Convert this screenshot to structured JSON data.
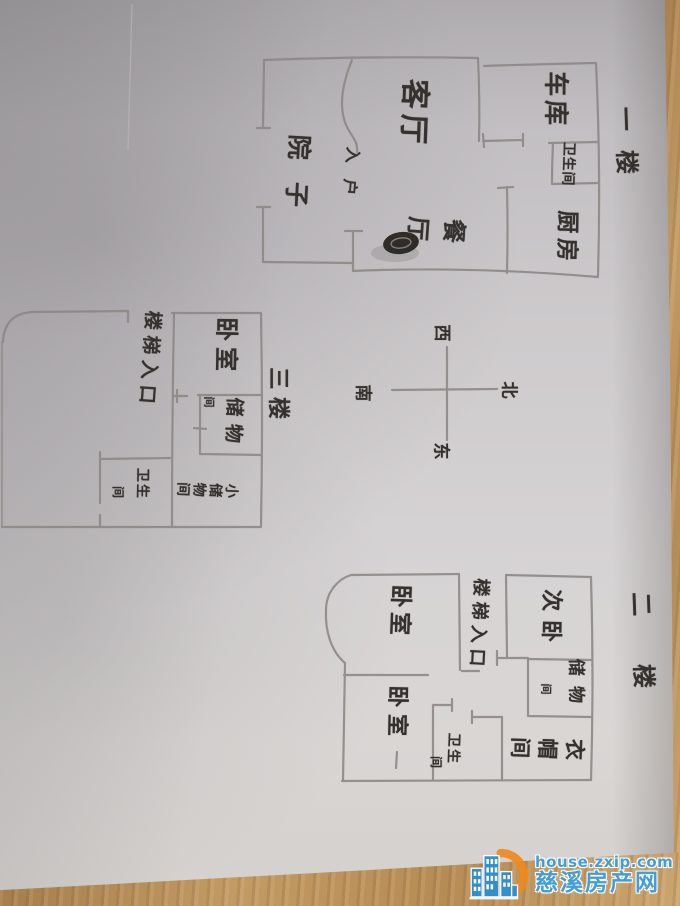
{
  "photo": {
    "description": "hand-drawn floor plan sketch on paper, photographed on a wooden desk",
    "paper_color": "#d0cdcf",
    "pencil_color": "#8b8785",
    "ink_color": "#34312e",
    "wood_color": "#b58c5c"
  },
  "floorplan": {
    "labels": [
      {
        "name": "living-room-label",
        "text": "客厅",
        "x": 413,
        "y": 114,
        "size": 30,
        "mode": "col",
        "ls": 0.17,
        "rot": 92
      },
      {
        "name": "garage-label",
        "text": "车库",
        "x": 556,
        "y": 100,
        "size": 25,
        "mode": "col",
        "ls": 0.15,
        "rot": 90
      },
      {
        "name": "floor1-title",
        "text": "一楼",
        "x": 626,
        "y": 150,
        "size": 24,
        "mode": "col",
        "ls": 0.8,
        "rot": 88
      },
      {
        "name": "floor1-bathroom-label",
        "text": "卫生间",
        "x": 568,
        "y": 164,
        "size": 14,
        "mode": "col",
        "ls": 0.05,
        "rot": 92
      },
      {
        "name": "kitchen-label",
        "text": "厨房",
        "x": 566,
        "y": 238,
        "size": 23,
        "mode": "col",
        "ls": 0.2,
        "rot": 91
      },
      {
        "name": "dining-room-label",
        "text": "餐厅",
        "x": 431,
        "y": 227,
        "size": 24,
        "mode": "row",
        "ls": 0.5,
        "rot": 94
      },
      {
        "name": "yard-label",
        "text": "院子",
        "x": 297,
        "y": 182,
        "size": 25,
        "mode": "col",
        "ls": 0.9,
        "rot": 93
      },
      {
        "name": "entry-label",
        "text": "入户",
        "x": 350,
        "y": 179,
        "size": 16,
        "mode": "col",
        "ls": 1.0,
        "rot": 95
      },
      {
        "name": "compass-west-label",
        "text": "西",
        "x": 441,
        "y": 333,
        "size": 17,
        "mode": "col",
        "ls": 0,
        "rot": 90
      },
      {
        "name": "compass-north-label",
        "text": "北",
        "x": 508,
        "y": 390,
        "size": 17,
        "mode": "col",
        "ls": 0,
        "rot": 90
      },
      {
        "name": "compass-east-label",
        "text": "东",
        "x": 440,
        "y": 451,
        "size": 17,
        "mode": "col",
        "ls": 0,
        "rot": 90
      },
      {
        "name": "compass-south-label",
        "text": "南",
        "x": 362,
        "y": 393,
        "size": 17,
        "mode": "col",
        "ls": 0,
        "rot": 90
      },
      {
        "name": "floor3-bedroom-label",
        "text": "卧室",
        "x": 226,
        "y": 347,
        "size": 24,
        "mode": "col",
        "ls": 0.25,
        "rot": 91
      },
      {
        "name": "floor3-stairs-entrance-label",
        "text": "楼梯入口",
        "x": 149,
        "y": 360,
        "size": 19,
        "mode": "col",
        "ls": 0.3,
        "rot": 94
      },
      {
        "name": "floor3-title",
        "text": "三楼",
        "x": 277,
        "y": 397,
        "size": 22,
        "mode": "col",
        "ls": 0.35,
        "rot": 90
      },
      {
        "name": "floor3-storage-label",
        "text": "储物",
        "x": 233,
        "y": 424,
        "size": 19,
        "mode": "col",
        "ls": 0.4,
        "rot": 92
      },
      {
        "name": "floor3-storage-label-suffix",
        "text": "间",
        "x": 209,
        "y": 402,
        "size": 11,
        "mode": "col",
        "ls": 0,
        "rot": 90
      },
      {
        "name": "floor3-small-storage-label",
        "text": "小储物间",
        "x": 207,
        "y": 489,
        "size": 14,
        "mode": "row",
        "ls": 0.15,
        "rot": 92
      },
      {
        "name": "floor3-bathroom-label",
        "text": "卫生",
        "x": 142,
        "y": 484,
        "size": 14,
        "mode": "col",
        "ls": 0.15,
        "rot": 91
      },
      {
        "name": "floor3-bathroom-label-suffix",
        "text": "间",
        "x": 118,
        "y": 492,
        "size": 12,
        "mode": "col",
        "ls": 0,
        "rot": 90
      },
      {
        "name": "floor2-bedroom-top-label",
        "text": "卧室",
        "x": 399,
        "y": 612,
        "size": 23,
        "mode": "col",
        "ls": 0.2,
        "rot": 92
      },
      {
        "name": "floor2-stairs-entrance-label",
        "text": "楼梯入口",
        "x": 478,
        "y": 625,
        "size": 18,
        "mode": "col",
        "ls": 0.3,
        "rot": 93
      },
      {
        "name": "floor2-second-bedroom-label",
        "text": "次卧",
        "x": 550,
        "y": 620,
        "size": 22,
        "mode": "col",
        "ls": 0.4,
        "rot": 91
      },
      {
        "name": "floor2-storage-label",
        "text": "储物",
        "x": 575,
        "y": 686,
        "size": 17,
        "mode": "col",
        "ls": 0.6,
        "rot": 90
      },
      {
        "name": "floor2-storage-label-suffix",
        "text": "间",
        "x": 546,
        "y": 689,
        "size": 11,
        "mode": "col",
        "ls": 0,
        "rot": 90
      },
      {
        "name": "floor2-bedroom-bottom-label",
        "text": "卧室",
        "x": 396,
        "y": 714,
        "size": 22,
        "mode": "col",
        "ls": 0.3,
        "rot": 91
      },
      {
        "name": "floor2-bathroom-label",
        "text": "卫生",
        "x": 453,
        "y": 749,
        "size": 14,
        "mode": "col",
        "ls": 0.15,
        "rot": 92
      },
      {
        "name": "floor2-bathroom-label-suffix",
        "text": "间",
        "x": 436,
        "y": 762,
        "size": 12,
        "mode": "col",
        "ls": 0,
        "rot": 90
      },
      {
        "name": "floor2-cloakroom-label",
        "text": "衣帽间",
        "x": 545,
        "y": 747,
        "size": 21,
        "mode": "row",
        "ls": 0.3,
        "rot": 92
      },
      {
        "name": "floor2-title",
        "text": "二楼",
        "x": 643,
        "y": 664,
        "size": 24,
        "mode": "col",
        "ls": 2.0,
        "rot": 88
      }
    ]
  },
  "watermark": {
    "url": "house.zxip.com",
    "site": "慈溪房产网",
    "blue": "#3f9fd8",
    "orange": "#ef8a1c"
  }
}
